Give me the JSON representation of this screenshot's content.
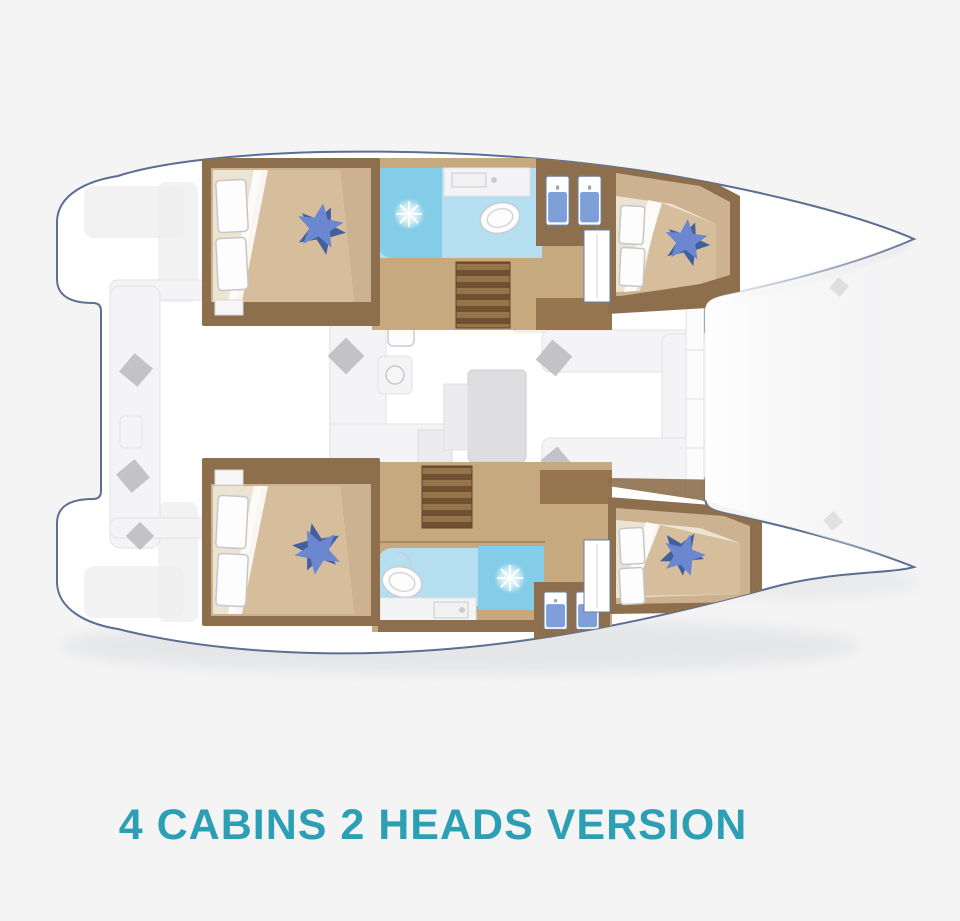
{
  "title": {
    "text": "4 CABINS 2 HEADS VERSION"
  },
  "colors": {
    "bg": "#f4f4f5",
    "accent": "#2d9fb5",
    "hull_fill": "#ffffff",
    "hull_outline": "#5d6e93",
    "wall_brown": "#8d6f4e",
    "floor_tan": "#cdb292",
    "corridor_tan": "#c7a980",
    "bed_cream": "#ece4d2",
    "duvet_tan": "#d6bd9c",
    "head_blue": "#b5dff0",
    "shower_blue": "#84cde8",
    "star_blue": "#6a87cf",
    "star_blue_dark": "#42609f",
    "pillow_white": "#fdfdfd",
    "cushion_gray": "#c3c3c7",
    "stair_light": "#96744c",
    "stair_dark": "#6f5131",
    "furniture_white": "#f4f4f6",
    "furniture_gray": "#dedee1",
    "stove_gray": "#76767a",
    "door_blue": "#7f9fd8",
    "shadow": "#d9dbdd"
  },
  "diagram": {
    "type": "boat-floor-plan",
    "vessel": "catamaran",
    "rooms": [
      {
        "id": "cabin-top-left",
        "kind": "double-cabin"
      },
      {
        "id": "cabin-top-right",
        "kind": "double-cabin"
      },
      {
        "id": "cabin-bottom-left",
        "kind": "double-cabin"
      },
      {
        "id": "cabin-bottom-right",
        "kind": "double-cabin"
      },
      {
        "id": "head-top",
        "kind": "head-with-shower"
      },
      {
        "id": "head-bottom",
        "kind": "head-with-shower"
      },
      {
        "id": "salon",
        "kind": "salon-galley-dinette"
      },
      {
        "id": "cockpit",
        "kind": "aft-cockpit"
      }
    ],
    "icons": [
      "star-cushion-icon",
      "shower-spray-icon",
      "toilet-icon",
      "stove-icon",
      "sink-icon",
      "stairs-icon",
      "wardrobe-doors-icon",
      "washbasin-pair-icon",
      "throw-cushion-icon",
      "bow-cleat-icon"
    ]
  }
}
